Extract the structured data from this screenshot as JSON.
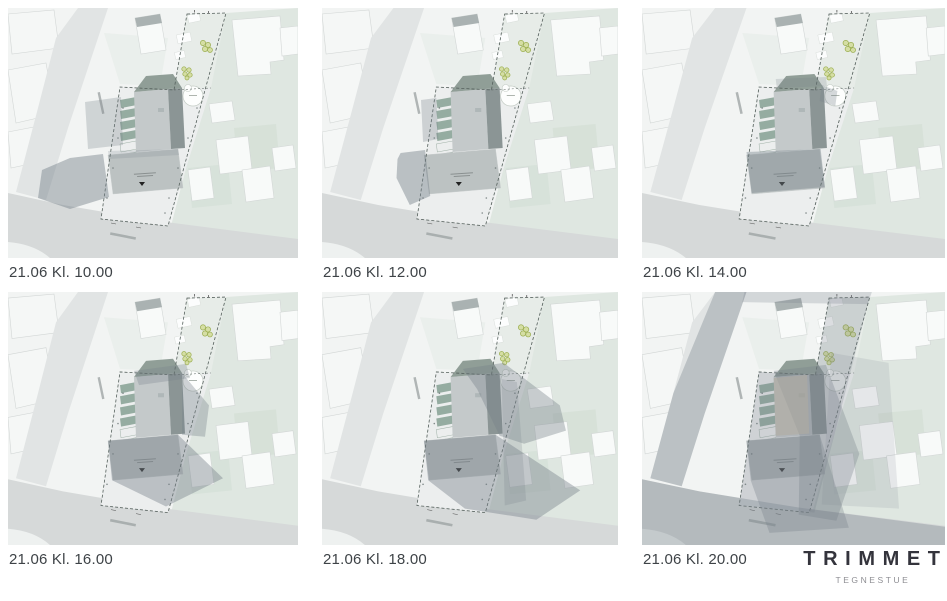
{
  "document": {
    "type": "sun-shadow-study-sheet",
    "date_label": "21.06",
    "caption_color": "#3e4347"
  },
  "panels": [
    {
      "caption": "21.06 Kl. 10.00",
      "time": "10.00",
      "shadows": [
        {
          "points": "77,94 113,89 115,137 80,141",
          "opacity": 0.28
        },
        {
          "points": "95,146 101,189 62,201 30,190 34,162 62,150",
          "opacity": 0.45
        },
        {
          "points": "100,143 170,141 171,147 101,151",
          "opacity": 0.2
        }
      ]
    },
    {
      "caption": "21.06 Kl. 12.00",
      "time": "12.00",
      "shadows": [
        {
          "points": "97,92 112,90 114,131 99,134",
          "opacity": 0.3
        },
        {
          "points": "77,145 101,142 106,188 86,197 73,170 74,151",
          "opacity": 0.45
        }
      ]
    },
    {
      "caption": "21.06 Kl. 14.00",
      "time": "14.00",
      "shadows": [
        {
          "points": "100,144 171,141 175,179 105,185",
          "opacity": 0.4
        },
        {
          "points": "172,77 187,83 185,98 170,93",
          "opacity": 0.3
        },
        {
          "points": "128,71 176,69 177,78 129,80",
          "opacity": 0.22
        }
      ]
    },
    {
      "caption": "21.06 Kl. 16.00",
      "time": "16.00",
      "shadows": [
        {
          "points": "126,78 178,71 182,85 131,92",
          "opacity": 0.3
        },
        {
          "points": "174,80 201,112 197,143 174,141",
          "opacity": 0.35
        },
        {
          "points": "100,147 170,141 215,184 158,212 104,186",
          "opacity": 0.42
        }
      ]
    },
    {
      "caption": "21.06 Kl. 18.00",
      "time": "18.00",
      "shadows": [
        {
          "points": "138,76 178,70 233,112 239,137 198,150 174,142 152,96",
          "opacity": 0.38
        },
        {
          "points": "100,147 170,141 253,196 210,225 140,214 104,186",
          "opacity": 0.42
        },
        {
          "points": "176,86 191,89 200,206 179,211",
          "opacity": 0.22
        }
      ]
    },
    {
      "caption": "21.06 Kl. 20.00",
      "time": "20.00",
      "shadows": [
        {
          "points": "70,0 100,0 60,120 38,192 8,184 30,100",
          "opacity": 0.35
        },
        {
          "points": "0,185 55,197 150,213 290,232 290,258 0,258",
          "opacity": 0.35
        },
        {
          "points": "179,6 218,5 165,218 93,211 112,79 166,82",
          "opacity": 0.25
        },
        {
          "points": "126,78 176,72 208,160 186,226 150,220 151,142",
          "opacity": 0.32
        },
        {
          "points": "100,147 170,141 198,233 122,238 104,186",
          "opacity": 0.32
        },
        {
          "points": "181,60 236,70 246,214 172,210",
          "opacity": 0.15
        },
        {
          "points": "126,85 158,82 160,140 128,142",
          "opacity": 0.55,
          "color": "#b0ac9f"
        },
        {
          "points": "98,0 220,0 216,12 96,10",
          "opacity": 0.25
        }
      ]
    }
  ],
  "logo": {
    "name": "TRIMMET",
    "subtitle": "TEGNESTUE",
    "color": "#34343c",
    "subtitle_color": "#8e8e93"
  },
  "map": {
    "colors": {
      "bg": "#f2f4f3",
      "parcel": "#f5f7f6",
      "outline": "#d3d7d6",
      "road": "#e1e4e4",
      "roadBottom": "#d6d9d9",
      "green": "#dfe7e1",
      "greenDark": "#cfdcd2",
      "building": "#f8faf9",
      "stripFill": "#e7ece8",
      "siteFill": "#eceeee",
      "roofLight": "#c4c9ca",
      "roofDark": "#8b9595",
      "roofWedge": "#909e97",
      "parking": "#86a093",
      "lowerRoof": "#bcc2c2",
      "shadow": "#76818a",
      "dash": "#55605c",
      "treeStroke": "#9aad4e",
      "treeFill": "#cdd987"
    }
  }
}
